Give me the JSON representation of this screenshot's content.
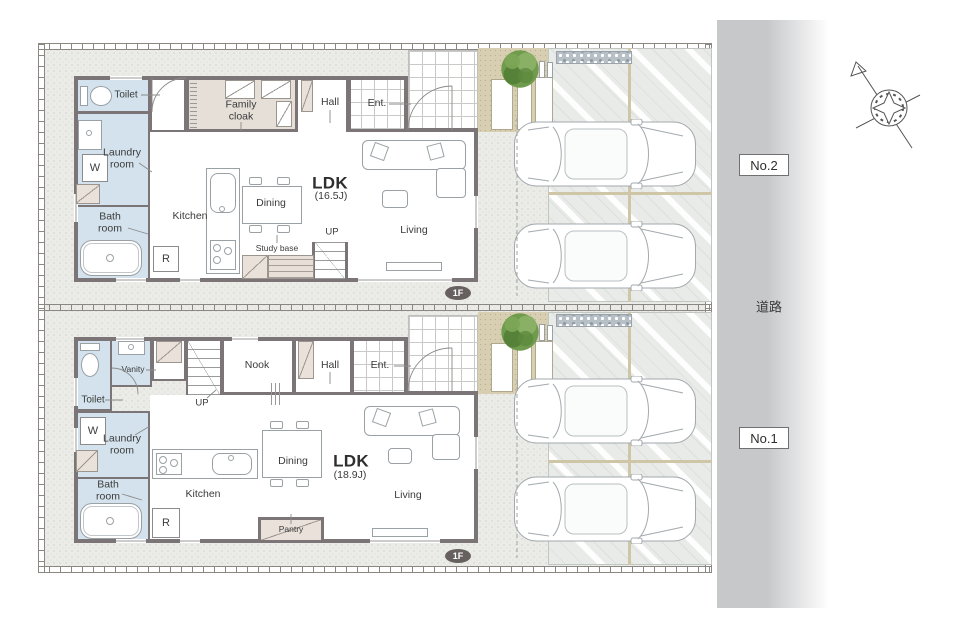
{
  "site": {
    "road_label": "道路",
    "palette": {
      "wall": "#7b7577",
      "wet_room_blue": "#d3e2ec",
      "closet_beige": "#e6dfd8",
      "ground": "#ebebe7",
      "approach_tan": "#d8ceb2",
      "road_gray": "#c7c8ca",
      "tree_green": "#6f9b4d"
    }
  },
  "units": [
    {
      "badge": "No.2",
      "floor_badge": "1F",
      "ldk": {
        "label": "LDK",
        "size": "(16.5J)"
      },
      "rooms": {
        "toilet": "Toilet",
        "family_cloak": "Family cloak",
        "hall": "Hall",
        "entrance": "Ent.",
        "laundry": "Laundry room",
        "washer": "W",
        "bath": "Bath room",
        "kitchen": "Kitchen",
        "fridge": "R",
        "dining": "Dining",
        "living": "Living",
        "study": "Study base",
        "stairs_up": "UP"
      }
    },
    {
      "badge": "No.1",
      "floor_badge": "1F",
      "ldk": {
        "label": "LDK",
        "size": "(18.9J)"
      },
      "rooms": {
        "toilet": "Toilet",
        "vanity": "Vanity",
        "nook": "Nook",
        "hall": "Hall",
        "entrance": "Ent.",
        "laundry": "Laundry room",
        "washer": "W",
        "bath": "Bath room",
        "kitchen": "Kitchen",
        "fridge": "R",
        "dining": "Dining",
        "living": "Living",
        "pantry": "Pantry",
        "stairs_up": "UP"
      }
    }
  ]
}
